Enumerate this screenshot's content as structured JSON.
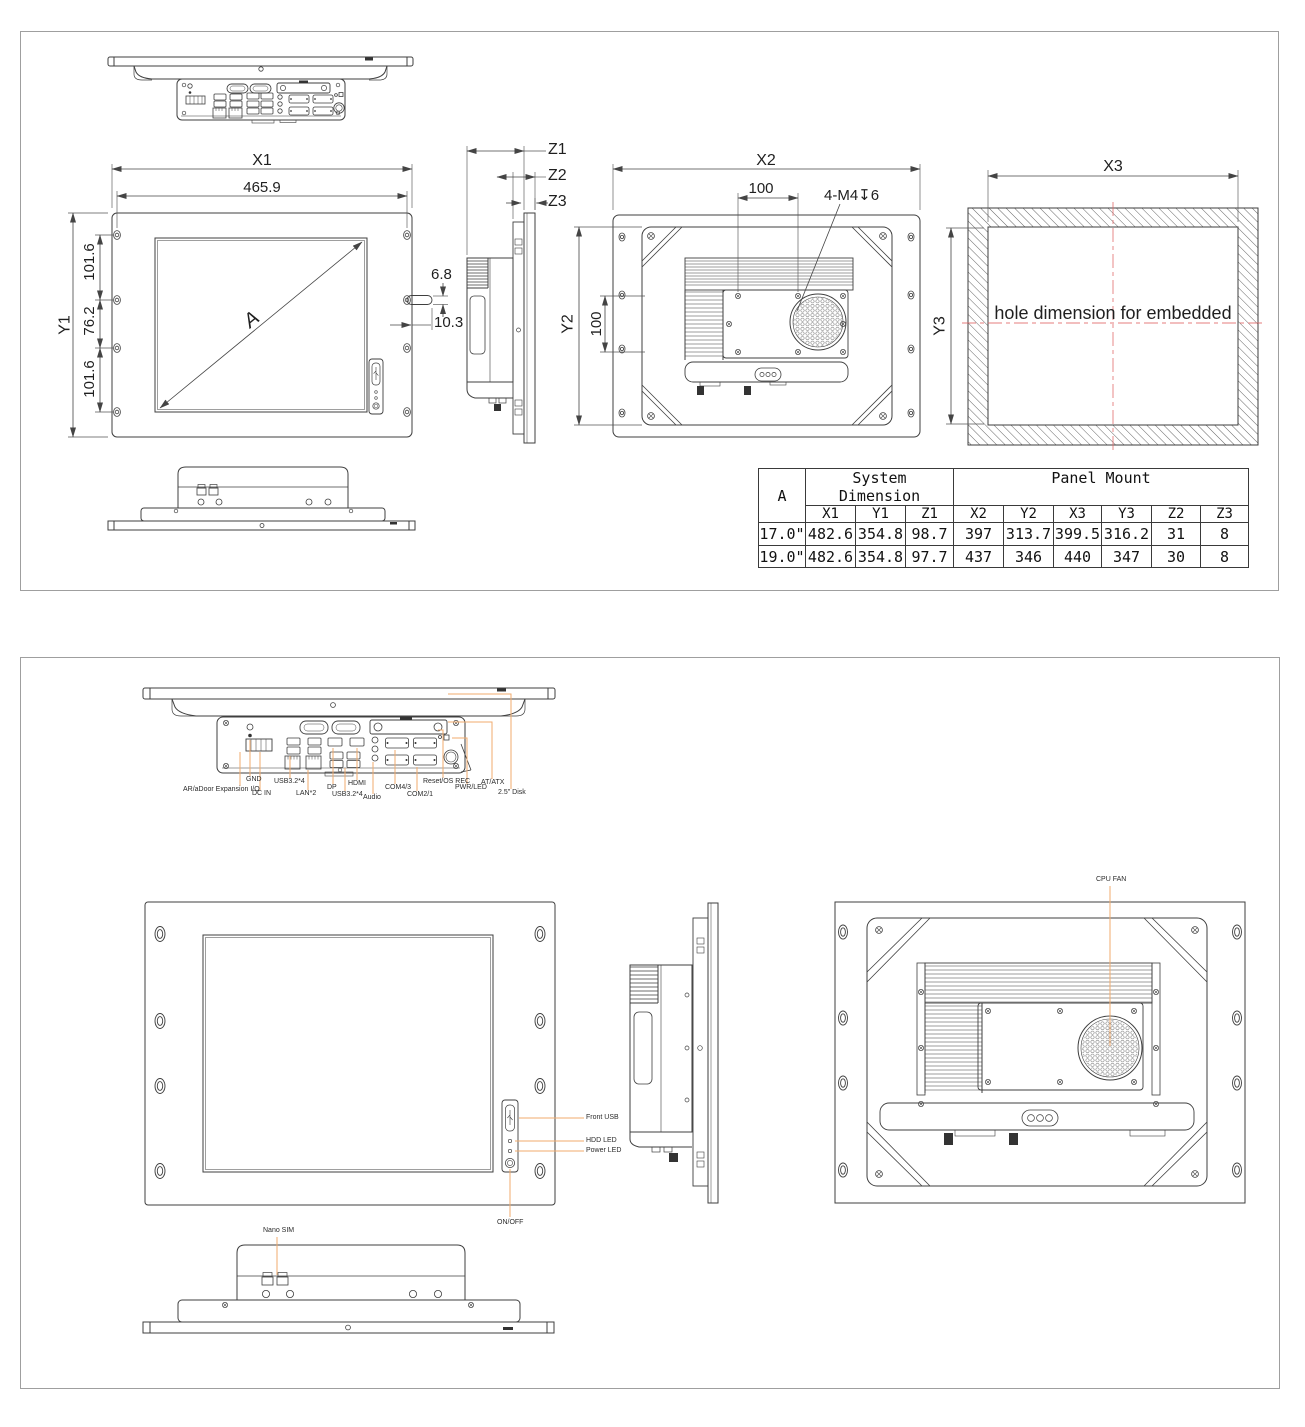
{
  "colors": {
    "ink": "#3f3f3f",
    "dim_line": "#444444",
    "leader_orange": "#f0ab6e",
    "centerline_red": "#e06666",
    "sheet_border": "#9f9f9f"
  },
  "panel1": {
    "front": {
      "x1": "X1",
      "width_465": "465.9",
      "y1": "Y1",
      "left_segments": [
        "101.6",
        "76.2",
        "101.6"
      ],
      "handle_thickness": "6.8",
      "handle_depth": "10.3",
      "diagonal": "A"
    },
    "side": {
      "z1": "Z1",
      "z2": "Z2",
      "z3": "Z3"
    },
    "rear": {
      "x2": "X2",
      "vesa_h": "100",
      "thread": "4-M4↧6",
      "y2": "Y2",
      "vesa_v": "100"
    },
    "embedded": {
      "x3": "X3",
      "y3": "Y3",
      "caption": "hole dimension for embedded"
    },
    "table": {
      "corner": "A",
      "group_system_line1": "System",
      "group_system_line2": "Dimension",
      "group_panel": "Panel Mount",
      "columns": [
        "X1",
        "Y1",
        "Z1",
        "X2",
        "Y2",
        "X3",
        "Y3",
        "Z2",
        "Z3"
      ],
      "rows": [
        {
          "size": "17.0\"",
          "values": [
            "482.6",
            "354.8",
            "98.7",
            "397",
            "313.7",
            "399.5",
            "316.2",
            "31",
            "8"
          ]
        },
        {
          "size": "19.0\"",
          "values": [
            "482.6",
            "354.8",
            "97.7",
            "437",
            "346",
            "440",
            "347",
            "30",
            "8"
          ]
        }
      ]
    }
  },
  "panel2": {
    "io_labels": [
      {
        "text": "GND"
      },
      {
        "text": "AR/aDoor Expansion I/O"
      },
      {
        "text": "DC IN"
      },
      {
        "text": "USB3.2*4"
      },
      {
        "text": "LAN*2"
      },
      {
        "text": "DP"
      },
      {
        "text": "USB3.2*4"
      },
      {
        "text": "HDMI"
      },
      {
        "text": "Audio"
      },
      {
        "text": "COM4/3"
      },
      {
        "text": "COM2/1"
      },
      {
        "text": "Reset/OS REC"
      },
      {
        "text": "PWR/LED"
      },
      {
        "text": "AT/ATX"
      },
      {
        "text": "2.5\" Disk"
      }
    ],
    "front_labels": {
      "front_usb": "Front USB",
      "hdd_led": "HDD LED",
      "power_led": "Power LED",
      "on_off": "ON/OFF"
    },
    "bottom_labels": {
      "nano_sim": "Nano SIM"
    },
    "rear_labels": {
      "cpu_fan": "CPU FAN"
    }
  }
}
